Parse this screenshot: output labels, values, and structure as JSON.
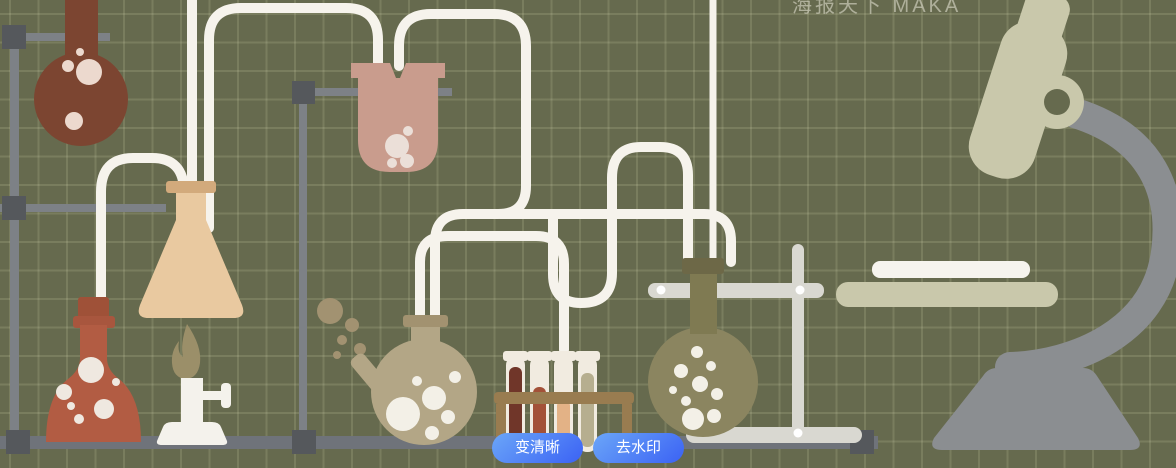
{
  "overlay": {
    "buttons": [
      {
        "label": "变清晰"
      },
      {
        "label": "去水印"
      }
    ],
    "button_style": {
      "gradient_start": "#6ba6f8",
      "gradient_end": "#3b62f4",
      "text_color": "#ffffff"
    }
  },
  "watermark": {
    "text": "海报天下 MAKA"
  },
  "scene": {
    "description": "flat chemistry-lab illustration on blackboard-style grid",
    "background": {
      "color": "#666a4e",
      "grid_line_color": "#7b7f61",
      "grid_cell_px": 28
    },
    "palette": {
      "tube_white": "#f6f3ec",
      "rod_gray": "#7d8186",
      "connector_dark": "#55585c",
      "bench_gray": "#6f737a",
      "flask_dark_brown": "#7c4531",
      "erlenmeyer_tan": "#e9c9a0",
      "erlenmeyer_rim": "#d2aa7c",
      "flask_red": "#b25c43",
      "stopper_red": "#9f5138",
      "burner_white": "#f4f2ec",
      "flame_olive": "#9b8f69",
      "beaker_pink": "#c99c8d",
      "retort_tan": "#b3a686",
      "retort_rim": "#a29270",
      "olive_bubbles": "#a29271",
      "tube_glass": "#f1ebe0",
      "tube_liquids": [
        "#703629",
        "#a35138",
        "#e3b286",
        "#b6ae8f"
      ],
      "rack_brown": "#997c50",
      "flask_olive_body": "#8b8560",
      "flask_olive_neck": "#7f7a52",
      "flask_olive_rim": "#6d6847",
      "stand_light": "#d9d8d1",
      "microscope_beige": "#c9c8ab",
      "microscope_gray": "#8b8e91",
      "bubble_light": "#efe8e0"
    },
    "items": [
      "round-flask-dark-brown",
      "erlenmeyer-flask",
      "round-flask-red",
      "alcohol-burner",
      "flame",
      "hanging-beaker",
      "retort-flask",
      "test-tube-rack",
      "test-tubes",
      "round-flask-olive",
      "lab-stands",
      "glass-tubing",
      "microscope"
    ]
  }
}
